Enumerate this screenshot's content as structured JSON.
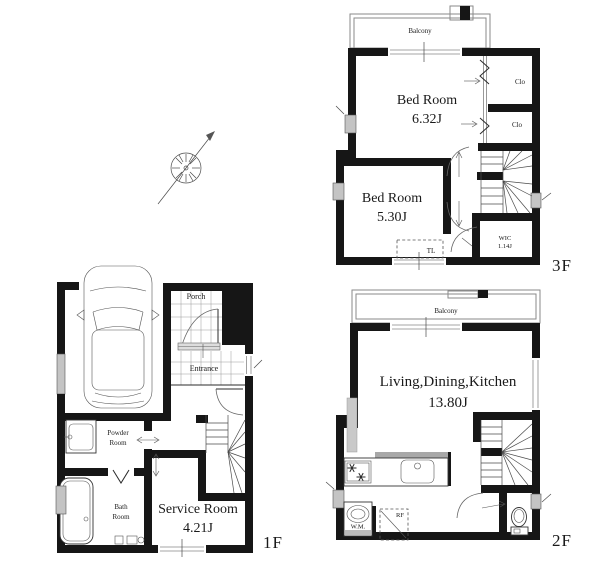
{
  "floor3": {
    "floor_label": "3F",
    "balcony_label": "Balcony",
    "bedroom_a": {
      "name": "Bed Room",
      "area": "6.32J"
    },
    "bedroom_b": {
      "name": "Bed Room",
      "area": "5.30J"
    },
    "closet_a": "Clo",
    "closet_b": "Clo",
    "toilet_label": "TL",
    "wic": {
      "name": "WIC",
      "area": "1.14J"
    }
  },
  "floor2": {
    "floor_label": "2F",
    "balcony_label": "Balcony",
    "ldk": {
      "name": "Living,Dining,Kitchen",
      "area": "13.80J"
    },
    "washing_machine_label": "W.M.",
    "refrigerator_label": "RF"
  },
  "floor1": {
    "floor_label": "1F",
    "porch_label": "Porch",
    "entrance_label": "Entrance",
    "powder_room": {
      "line1": "Powder",
      "line2": "Room"
    },
    "bath_room": {
      "line1": "Bath",
      "line2": "Room"
    },
    "service_room": {
      "name": "Service Room",
      "area": "4.21J"
    }
  },
  "colors": {
    "wall": "#161616",
    "railing": "#8a8a8a",
    "vent": "#c4c4c4",
    "text": "#1a1a1a",
    "background": "#ffffff"
  }
}
